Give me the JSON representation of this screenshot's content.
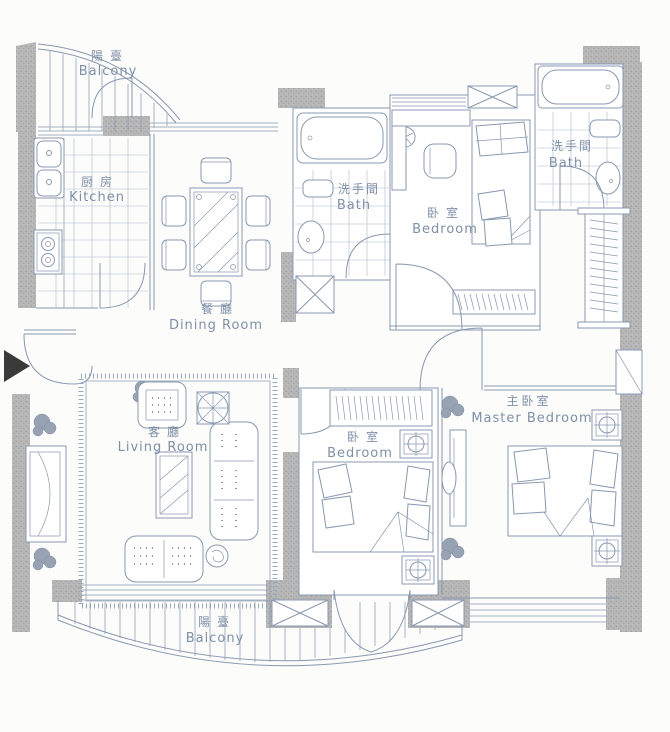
{
  "title": "apartment-floor-plan",
  "colors": {
    "line": "#8798b0",
    "wall_fill": "#b4b4b4",
    "label_text": "#7e90a8",
    "entry_arrow": "#3a3a3a",
    "background": "#fcfcfb"
  },
  "rooms": [
    {
      "id": "balcony-top",
      "zh": "陽臺",
      "en": "Balcony"
    },
    {
      "id": "kitchen",
      "zh": "厨房",
      "en": "Kitchen"
    },
    {
      "id": "dining-room",
      "zh": "餐廳",
      "en": "Dining Room"
    },
    {
      "id": "bath-1",
      "zh": "洗手間",
      "en": "Bath"
    },
    {
      "id": "bedroom-1",
      "zh": "卧室",
      "en": "Bedroom"
    },
    {
      "id": "bath-2",
      "zh": "洗手間",
      "en": "Bath"
    },
    {
      "id": "living-room",
      "zh": "客廳",
      "en": "Living Room"
    },
    {
      "id": "bedroom-2",
      "zh": "卧室",
      "en": "Bedroom"
    },
    {
      "id": "master-bedroom",
      "zh": "主卧室",
      "en": "Master Bedroom"
    },
    {
      "id": "balcony-bottom",
      "zh": "陽臺",
      "en": "Balcony"
    }
  ],
  "symbols": {
    "entry_arrow": "entry direction marker",
    "x_box": "shaft-duct symbol",
    "column_marker": "structural column symbol"
  }
}
